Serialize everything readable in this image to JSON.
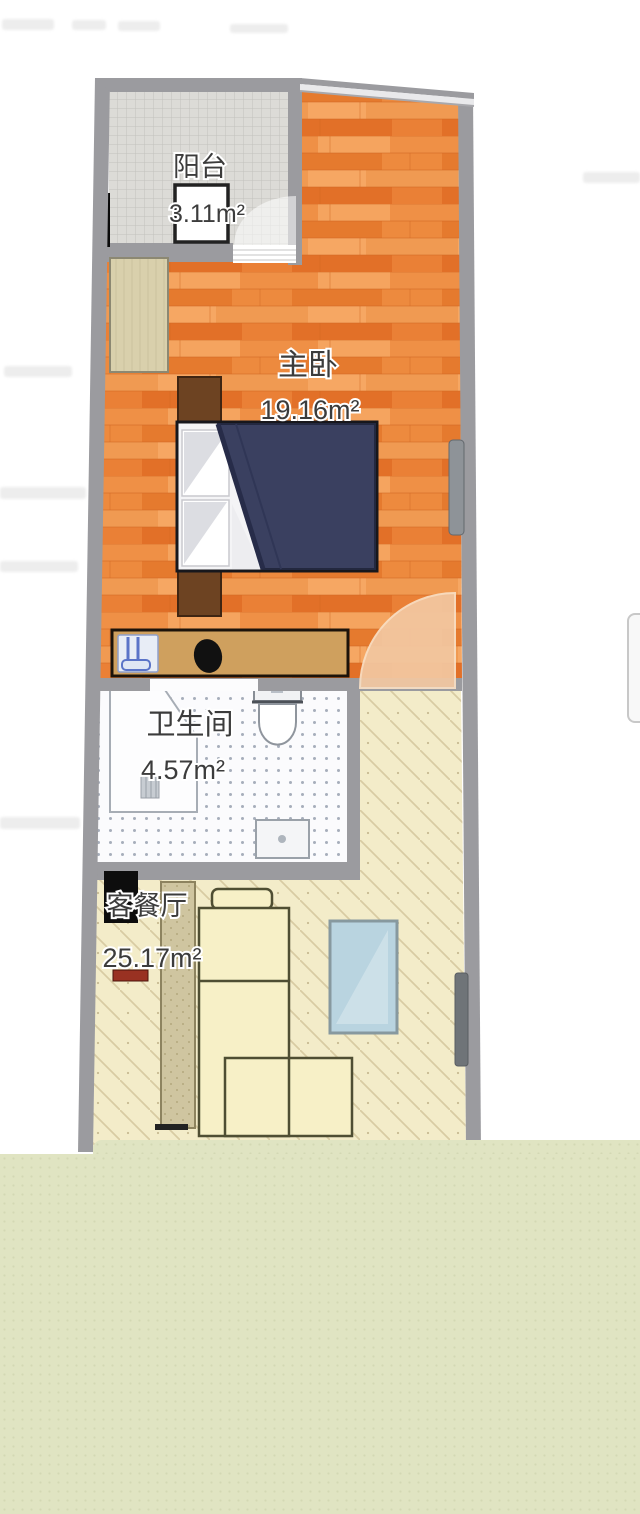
{
  "floor_plan": {
    "rooms": [
      {
        "id": "balcony",
        "name": "阳台",
        "area": "3.11m²"
      },
      {
        "id": "master-bedroom",
        "name": "主卧",
        "area": "19.16m²"
      },
      {
        "id": "bathroom",
        "name": "卫生间",
        "area": "4.57m²"
      },
      {
        "id": "living-dining-room",
        "name": "客餐厅",
        "area": "25.17m²"
      }
    ],
    "colors": {
      "wall": "#9b9b9f",
      "bedroom_floor": "#e9843a",
      "balcony_tile": "#dcdbd7",
      "bathroom_tile": "#fbfbfd",
      "living_floor": "#f3ecc9",
      "door_swing": "#f3c8a2",
      "duvet_navy": "#3a4060",
      "bottom_sheet": "#e0e4c2"
    }
  }
}
